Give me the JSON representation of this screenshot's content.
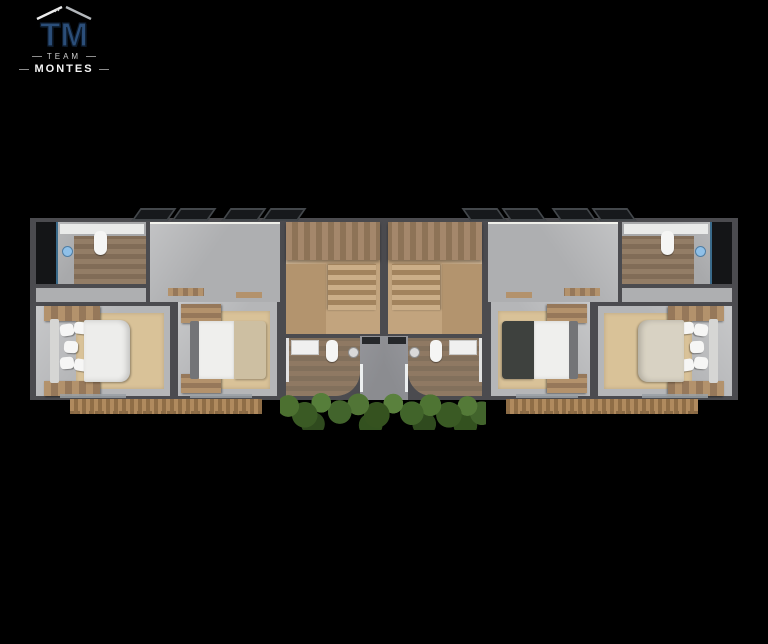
{
  "logo": {
    "monogram": "TM",
    "team": "TEAM",
    "name": "MONTES"
  },
  "colors": {
    "background": "#000000",
    "wall": "#4b4b4f",
    "floor": "#b5b6b8",
    "corridor": "#aeafb1",
    "wood": "#b3926c",
    "wood-dark": "#96785a",
    "wood-floor": "#c2a47e",
    "panel": "#a4876b",
    "tile": "#8f7963",
    "bath-tile": "#937d66",
    "rug": "#d9c298",
    "bed-white": "#ededeb",
    "bed-greige": "#d8d2c3",
    "headboard-dark": "#737477",
    "throw-beige": "#cdbfa2",
    "throw-dark": "#3e413e",
    "concrete": "#8b8c90",
    "deck": "#b08a5e",
    "green": "#49672f",
    "shower-glass": "#8fc0e8",
    "logo-blue": "#2b4e79",
    "logo-outline": "#0d1b2c"
  }
}
